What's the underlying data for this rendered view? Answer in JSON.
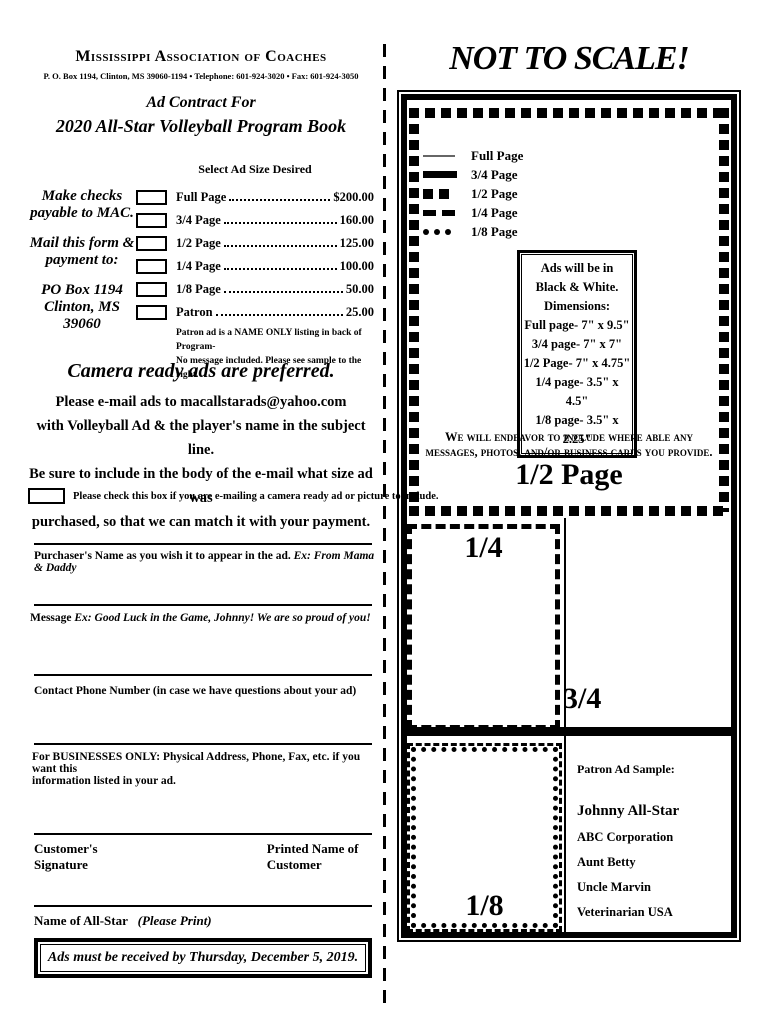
{
  "left": {
    "org_name": "Mississippi Association of Coaches",
    "address": "P. O. Box 1194, Clinton, MS 39060-1194 • Telephone: 601-924-3020 • Fax: 601-924-3050",
    "contract_title": "Ad Contract For",
    "book_title": "2020 All-Star Volleyball Program Book",
    "pay_line_1": "Make checks",
    "pay_line_2": "payable to MAC.",
    "pay_line_3": "Mail this form &",
    "pay_line_4": "payment to:",
    "pay_line_5": "PO Box 1194",
    "pay_line_6": "Clinton, MS  39060",
    "adsize_header": "Select Ad Size Desired",
    "ad_options": [
      {
        "label": "Full Page",
        "price": "$200.00"
      },
      {
        "label": "3/4 Page",
        "price": "160.00"
      },
      {
        "label": "1/2 Page",
        "price": "125.00"
      },
      {
        "label": "1/4 Page",
        "price": "100.00"
      },
      {
        "label": "1/8 Page",
        "price": "50.00"
      },
      {
        "label": "Patron",
        "price": "25.00"
      }
    ],
    "patron_note_1": "Patron ad is a NAME ONLY listing in back of Program-",
    "patron_note_2": "No message included. Please see sample to the right.",
    "camera_title": "Camera ready ads are preferred.",
    "email_line_1": "Please e-mail ads to macallstarads@yahoo.com",
    "email_line_2": "with Volleyball Ad  & the player's name in the subject line.",
    "email_line_3": "Be sure to include in the body of the e-mail what size ad was",
    "email_line_4": "purchased, so that we can match it with your payment.",
    "checkbox_label": "Please check this box if you are e-mailing a camera ready ad or picture to include.",
    "purchaser_label": "Purchaser's Name as you wish it to appear in the ad.",
    "purchaser_example": "Ex: From Mama & Daddy",
    "message_label": "Message",
    "message_example": "Ex:  Good Luck in the Game, Johnny! We are so proud of you!",
    "phone_label": "Contact Phone Number (in case we have questions about your ad)",
    "business_label_1": "For BUSINESSES ONLY:   Physical Address, Phone, Fax, etc.  if you want this",
    "business_label_2": "information listed in your ad.",
    "signature_label": "Customer's Signature",
    "printed_name_label": "Printed Name of Customer",
    "allstar_label": "Name of All-Star",
    "allstar_hint": "(Please Print)",
    "deadline": "Ads must be received by Thursday, December 5, 2019."
  },
  "right": {
    "title": "NOT TO SCALE!",
    "legend": [
      {
        "label": "Full Page"
      },
      {
        "label": "3/4 Page"
      },
      {
        "label": "1/2 Page"
      },
      {
        "label": "1/4 Page"
      },
      {
        "label": "1/8 Page"
      }
    ],
    "dims_line_1": "Ads will be in",
    "dims_line_2": "Black & White.",
    "dims_line_3": "Dimensions:",
    "dims_line_4": "Full page- 7\" x 9.5\"",
    "dims_line_5": "3/4 page- 7\" x 7\"",
    "dims_line_6": "1/2 Page- 7\" x 4.75\"",
    "dims_line_7": "1/4 page- 3.5\" x 4.5\"",
    "dims_line_8": "1/8 page- 3.5\" x 2.25\"",
    "endeavor_1": "We will endeavor to include where able any",
    "endeavor_2": "messages, photos,  and/or business cards you provide.",
    "label_half": "1/2 Page",
    "label_quarter": "1/4",
    "label_three_quarter": "3/4",
    "label_eighth": "1/8",
    "patron_title": "Patron Ad Sample:",
    "patron_names": [
      "Johnny All-Star",
      "ABC Corporation",
      "Aunt Betty",
      "Uncle Marvin",
      "Veterinarian USA"
    ]
  }
}
